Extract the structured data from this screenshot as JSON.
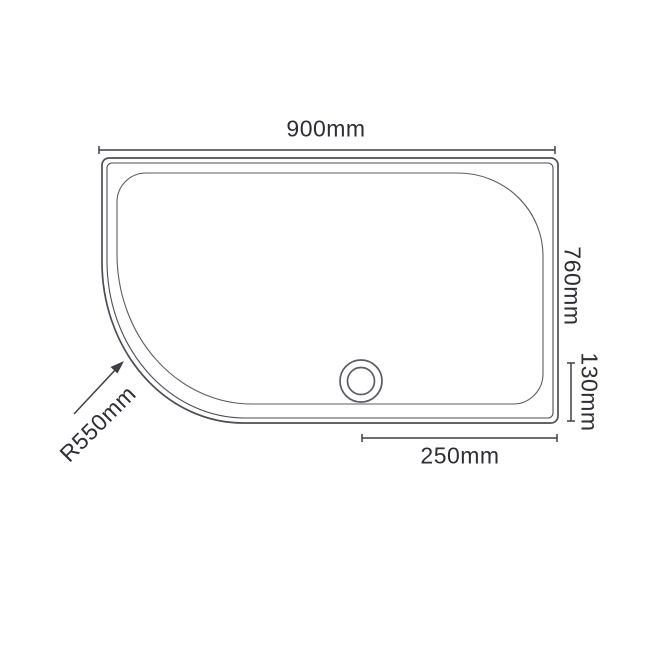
{
  "diagram": {
    "labels": {
      "width": "900mm",
      "depth": "760mm",
      "waste_offset_bottom": "130mm",
      "waste_offset_right": "250mm",
      "corner_radius": "R550mm"
    },
    "colors": {
      "tray_line": "#4d4d54",
      "basin_line": "#5c5c63",
      "dimension_line": "#3f3f46",
      "text": "#2e2e33",
      "background": "#ffffff"
    },
    "icons": {
      "drain": "drain-waste-circle-icon",
      "radius_pointer": "arrow-up-right-icon"
    }
  }
}
